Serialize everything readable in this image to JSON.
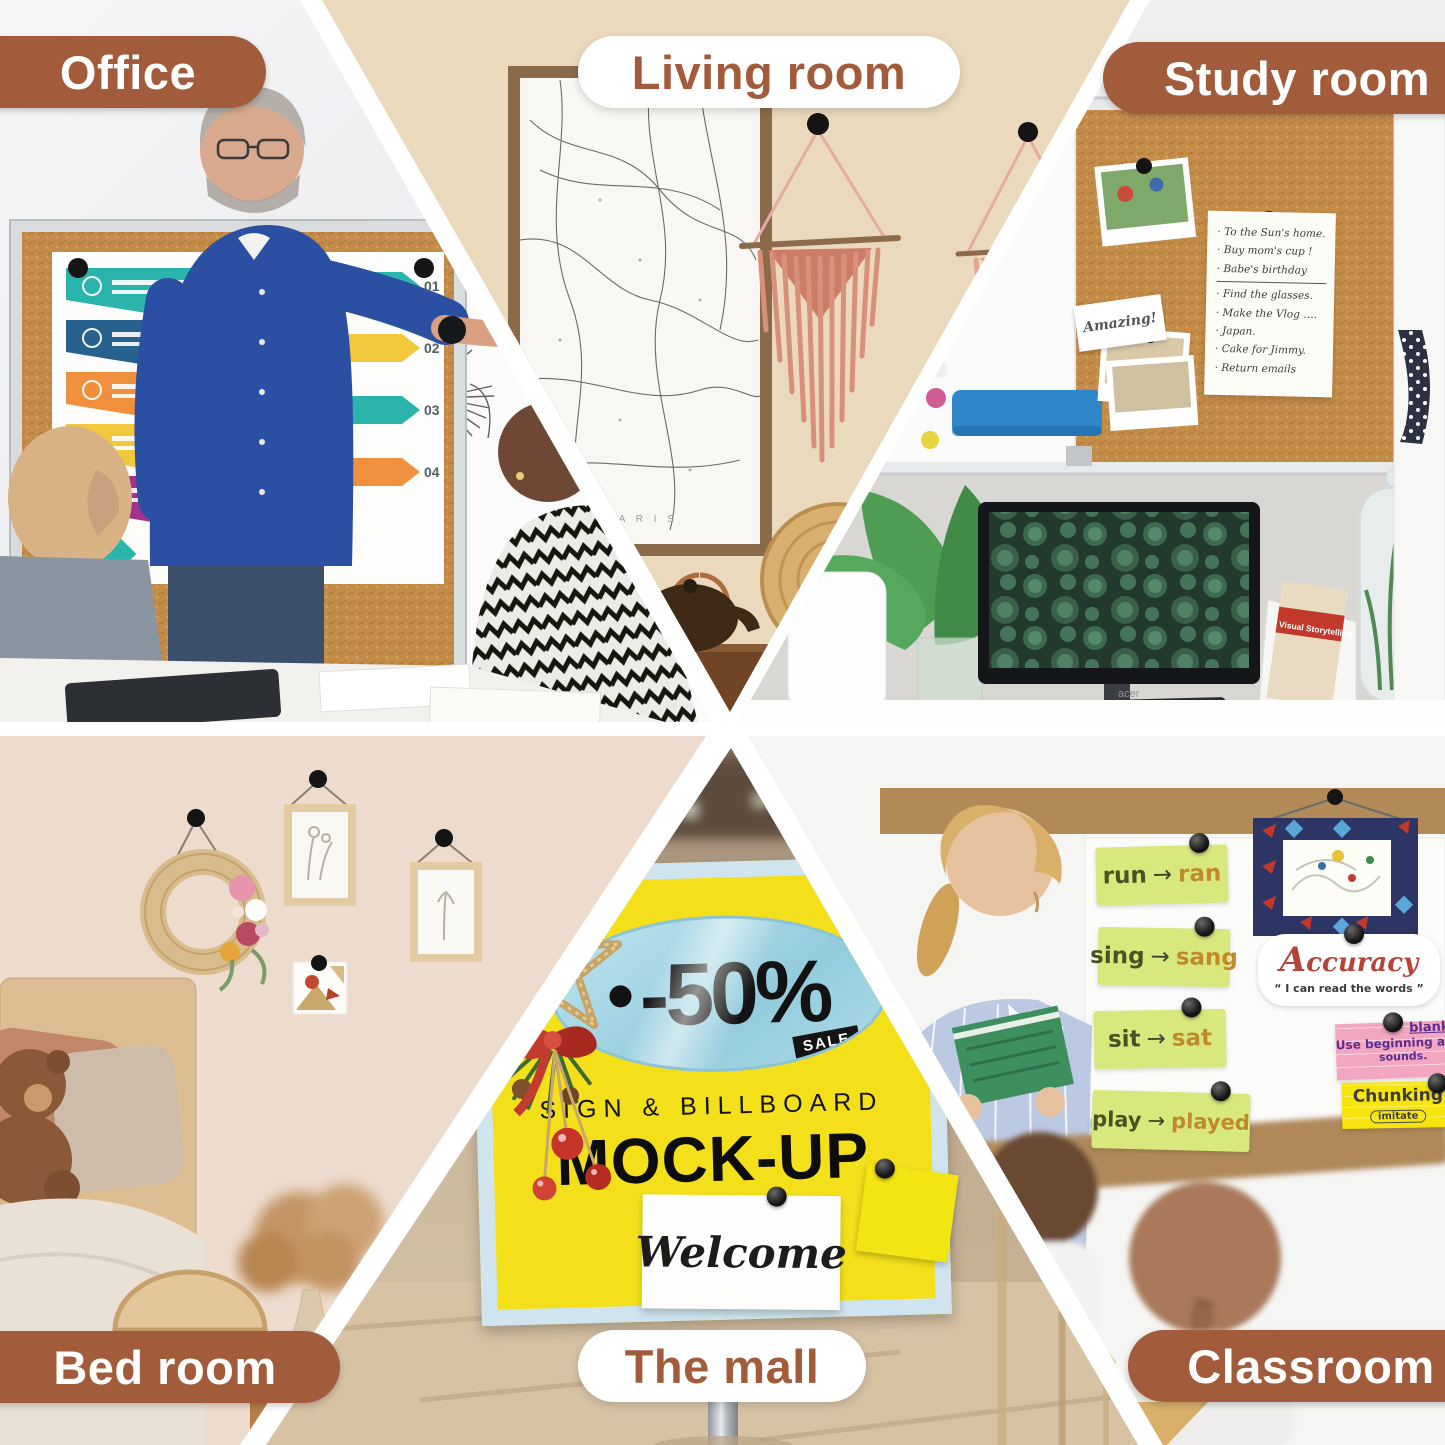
{
  "product_labels": {
    "office": "Office",
    "living_room": "Living room",
    "study_room": "Study room",
    "bed_room": "Bed room",
    "the_mall": "The mall",
    "classroom": "Classroom"
  },
  "colors": {
    "accent_brown": "#a35c3b",
    "pill_white": "#ffffff",
    "sign_yellow": "#f4e01a",
    "sign_border_blue": "#cfe4ef",
    "badge_blue": "#a6d9e8",
    "word_card_green": "#d9e87d",
    "pink_card": "#f2a6c0",
    "sticky_yellow": "#f6e40c",
    "cork": "#c48c49",
    "magnet_black": "#141414"
  },
  "office": {
    "poster_numbers": [
      "01",
      "02",
      "03",
      "04"
    ]
  },
  "living_room": {
    "map_caption": "P A R I S"
  },
  "study_room": {
    "todo_note_lines": [
      "To the Sun's home.",
      "Buy mom's cup !",
      "Babe's birthday",
      "Find the glasses.",
      "Make the Vlog ….",
      "Japan.",
      "Cake for Jimmy.",
      "Return emails"
    ],
    "amazing_note": "Amazing!"
  },
  "study_desk": {
    "monitor_brand": "acer",
    "book_title": "Visual Storytelling"
  },
  "the_mall": {
    "discount": "-50%",
    "sale_tag": "SALE",
    "headline": "SIGN & BILLBOARD",
    "title": "MOCK-UP",
    "welcome_card": "Welcome"
  },
  "classroom": {
    "word_cards": [
      {
        "from": "run",
        "arrow": "→",
        "to": "ran"
      },
      {
        "from": "sing",
        "arrow": "→",
        "to": "sang"
      },
      {
        "from": "sit",
        "arrow": "→",
        "to": "sat"
      },
      {
        "from": "play",
        "arrow": "→",
        "to": "played"
      }
    ],
    "accuracy_title": "Accuracy",
    "accuracy_quote": "“ I can read the words ”",
    "pink_card_word": "blanket",
    "pink_card_line1": "Use beginning and ending",
    "pink_card_line2": "sounds.",
    "yellow_card_title": "Chunking",
    "yellow_card_sub": "imitate"
  }
}
